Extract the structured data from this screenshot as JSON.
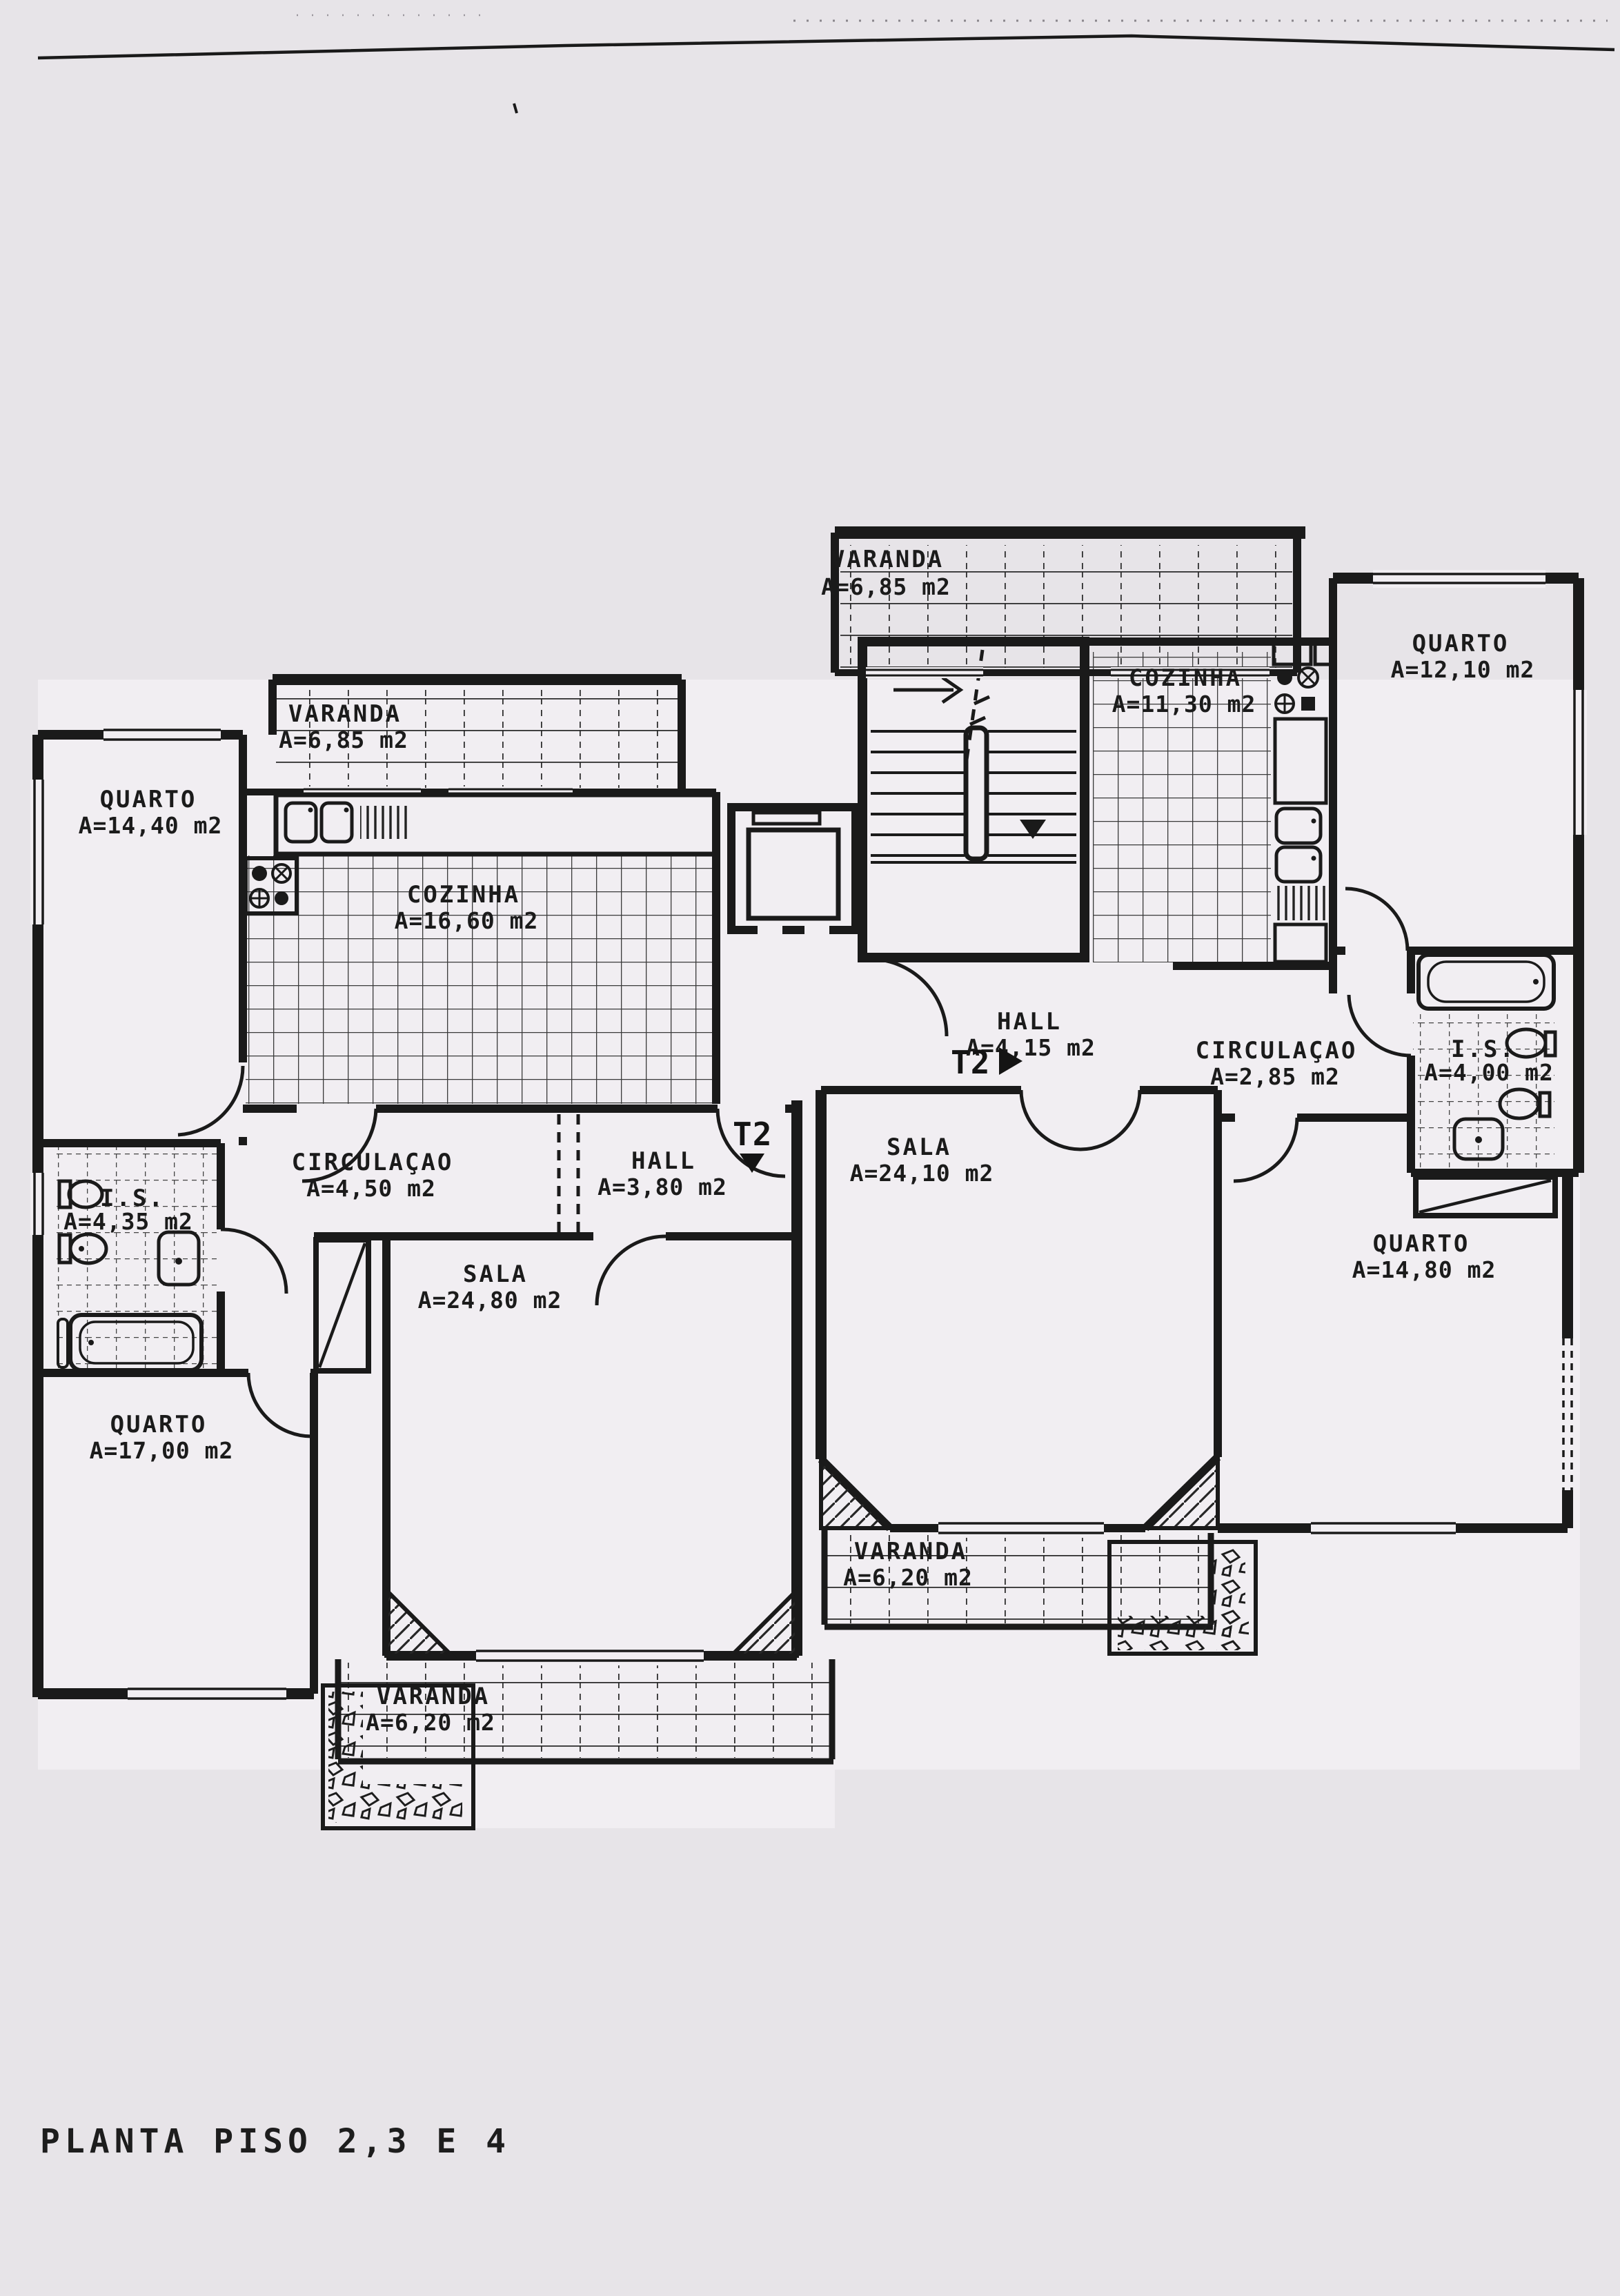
{
  "title": "PLANTA PISO 2,3 E 4",
  "unit_labels": {
    "left": "T2",
    "right": "T2"
  },
  "rooms": {
    "varanda_top": {
      "name": "VARANDA",
      "area": "A=6,85 m2"
    },
    "quarto_top_right": {
      "name": "QUARTO",
      "area": "A=12,10 m2"
    },
    "cozinha_right": {
      "name": "COZINHA",
      "area": "A=11,30 m2"
    },
    "varanda_left": {
      "name": "VARANDA",
      "area": "A=6,85 m2"
    },
    "quarto_left": {
      "name": "QUARTO",
      "area": "A=14,40 m2"
    },
    "cozinha_left": {
      "name": "COZINHA",
      "area": "A=16,60 m2"
    },
    "hall_right": {
      "name": "HALL",
      "area": "A=4,15 m2"
    },
    "circulacao_right": {
      "name": "CIRCULAÇAO",
      "area": "A=2,85 m2"
    },
    "is_right": {
      "name": "I.S.",
      "area": "A=4,00 m2"
    },
    "circulacao_left": {
      "name": "CIRCULAÇAO",
      "area": "A=4,50 m2"
    },
    "hall_left": {
      "name": "HALL",
      "area": "A=3,80 m2"
    },
    "sala_right": {
      "name": "SALA",
      "area": "A=24,10 m2"
    },
    "is_left": {
      "name": "I.S.",
      "area": "A=4,35 m2"
    },
    "sala_left": {
      "name": "SALA",
      "area": "A=24,80 m2"
    },
    "quarto_right": {
      "name": "QUARTO",
      "area": "A=14,80 m2"
    },
    "quarto_bottom_left": {
      "name": "QUARTO",
      "area": "A=17,00 m2"
    },
    "varanda_right": {
      "name": "VARANDA",
      "area": "A=6,20 m2"
    },
    "varanda_bottom": {
      "name": "VARANDA",
      "area": "A=6,20 m2"
    }
  },
  "colors": {
    "paper": "#e7e4e8",
    "ink": "#1a1a1a",
    "room_fill": "#f1eef2"
  }
}
